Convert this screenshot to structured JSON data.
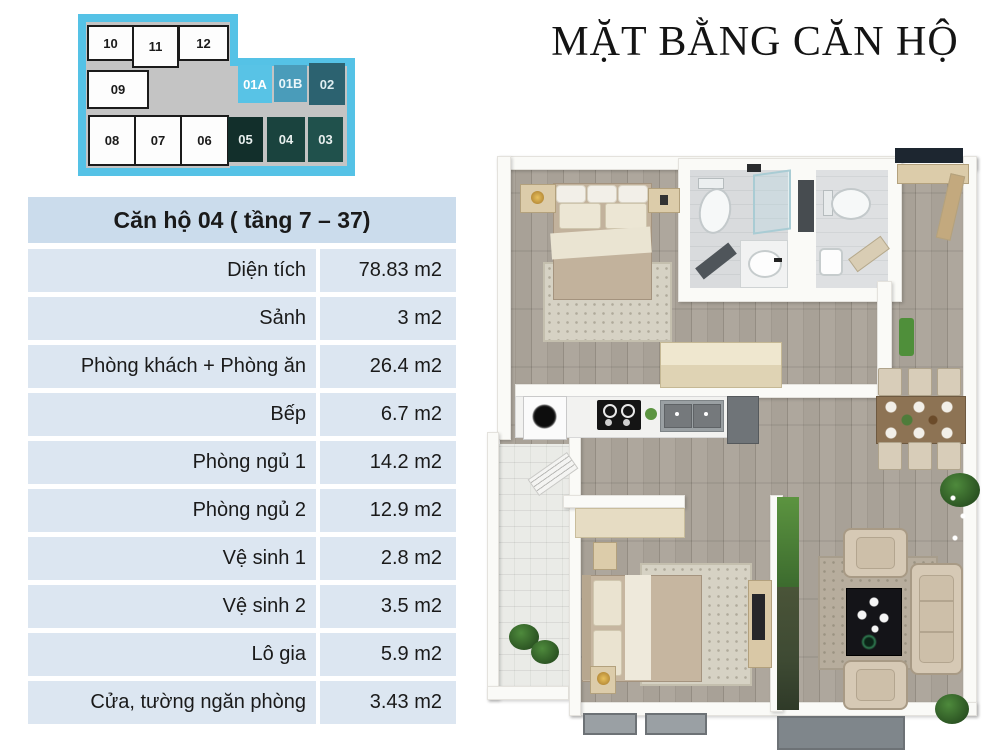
{
  "title": "MẶT BẰNG CĂN HỘ",
  "unit_map": {
    "border_color": "#55c2e6",
    "corridor_color": "#c4c4c4",
    "units": [
      {
        "label": "10"
      },
      {
        "label": "11"
      },
      {
        "label": "12"
      },
      {
        "label": "09"
      },
      {
        "label": "01A",
        "color": "#58c3e6"
      },
      {
        "label": "01B",
        "color": "#4a9cba"
      },
      {
        "label": "02",
        "color": "#2c6270"
      },
      {
        "label": "08"
      },
      {
        "label": "07"
      },
      {
        "label": "06"
      },
      {
        "label": "05",
        "color": "#122f2b"
      },
      {
        "label": "04",
        "color": "#1a433e"
      },
      {
        "label": "03",
        "color": "#20514c"
      }
    ]
  },
  "info_table": {
    "header": "Căn hộ 04 ( tầng 7 – 37)",
    "rows": [
      {
        "label": "Diện tích",
        "value": "78.83 m2"
      },
      {
        "label": "Sảnh",
        "value": "3 m2"
      },
      {
        "label": "Phòng khách + Phòng ăn",
        "value": "26.4 m2"
      },
      {
        "label": "Bếp",
        "value": "6.7 m2"
      },
      {
        "label": "Phòng ngủ 1",
        "value": "14.2 m2"
      },
      {
        "label": "Phòng ngủ 2",
        "value": "12.9 m2"
      },
      {
        "label": "Vệ sinh 1",
        "value": "2.8 m2"
      },
      {
        "label": "Vệ sinh 2",
        "value": "3.5 m2"
      },
      {
        "label": "Lô gia",
        "value": "5.9 m2"
      },
      {
        "label": "Cửa, tường ngăn phòng",
        "value": "3.43 m2"
      }
    ]
  },
  "floor_plan": {
    "palette": {
      "wood_floor": "#a8a197",
      "plank_line": "#948d83",
      "wall": "#fafaf7",
      "balcony_tile": "#eaebe7",
      "bath_floor": "#d9dbdd",
      "entry_door": "#1d2630",
      "dining_table_wood": "#8d7354",
      "upholstery": "#d6c9b5",
      "coffee_table": "#141418",
      "plant_green": "#2c5523",
      "mat_gray": "#9aa0a4"
    }
  }
}
